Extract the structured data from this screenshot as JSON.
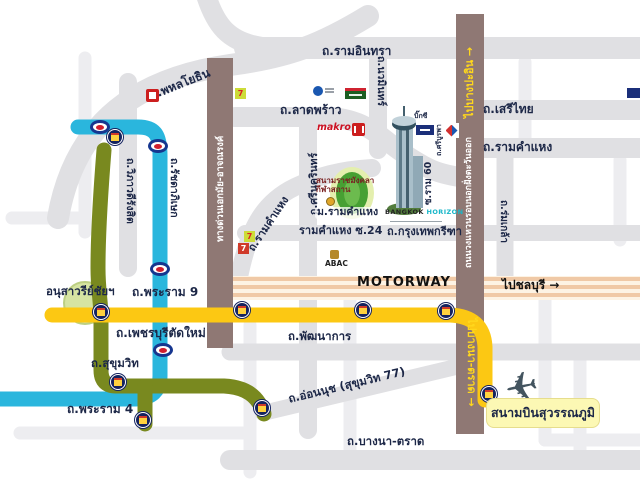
{
  "map": {
    "roads": {
      "phahonyothin": "ถ.พหลโยธิน",
      "ramindra": "ถ.รามอินทรา",
      "ladprao": "ถ.ลาดพร้าว",
      "navamin": "ถ.นวมินทร์",
      "vibhavadi": "ถ.วิภาวดีรังสิต",
      "ratchadaphisek": "ถ.รัชดาภิเษก",
      "serithai": "ถ.เสรีไทย",
      "ramkhamhaeng": "ถ.รามคำแหง",
      "ramkhamhaeng_west": "ถ.รามคำแหง",
      "srinakarin": "ถ.ศรีนครินทร์",
      "soi_ram_60": "ซ.ราม 60",
      "sriburapha": "ถ.ศรีบูรพา",
      "romklao": "ถ.ร่มเกล้า",
      "ramkhamhaeng_soi24": "รามคำแหง ซ.24",
      "krungthep_kreetha": "ถ.กรุงเทพกรีฑา",
      "motorway": "MOTORWAY",
      "phatthanakan": "ถ.พัฒนาการ",
      "onnut": "ถ.อ่อนนุช (สุขุมวิท 77)",
      "bangna_trad": "ถ.บางนา-ตราด",
      "rama4": "ถ.พระราม 4",
      "sukhumvit": "ถ.สุขุมวิท",
      "phetchaburi_tad_mai": "ถ.เพชรบุรีตัดใหม่",
      "rama9": "ถ.พระราม 9",
      "expressway_ekamai": "ทางด่วนเอกมัย-อาจณรงค์",
      "outer_ring": "ถนนวงแหวนรอบนอกฝั่งตะวันออก"
    },
    "directions": {
      "to_bang_pa_in": "ไปบางปะอิน →",
      "to_chonburi": "ไปชลบุรี →",
      "to_bangna_trad": "ไปบางนา-ตราด →"
    },
    "landmarks": {
      "victory_monument": "อนุสาวรีย์ชัยฯ",
      "stadium_line1": "สนามราชมังคลา",
      "stadium_line2": "กีฬาสถาน",
      "ramkhamhaeng_university": "ม.รามคำแหง",
      "abac": "ABAC",
      "suvarnabhumi_airport": "สนามบินสุวรรณภูมิ",
      "big_c": "บิ๊กซี"
    },
    "brands": {
      "makro": "makro",
      "building_line1": "BANGKOK",
      "building_line2": "HORIZON",
      "seven": "7"
    },
    "icons": {
      "plane_glyph": "✈"
    },
    "colors": {
      "expressway_brown": "#8f7874",
      "cyan_road": "#2ab6dd",
      "olive_road": "#79891f",
      "yellow_road": "#fcc813",
      "motorway_orange": "#f0c9a6",
      "label_navy": "#1c2747",
      "direction_yellow": "#ffd71c"
    }
  }
}
